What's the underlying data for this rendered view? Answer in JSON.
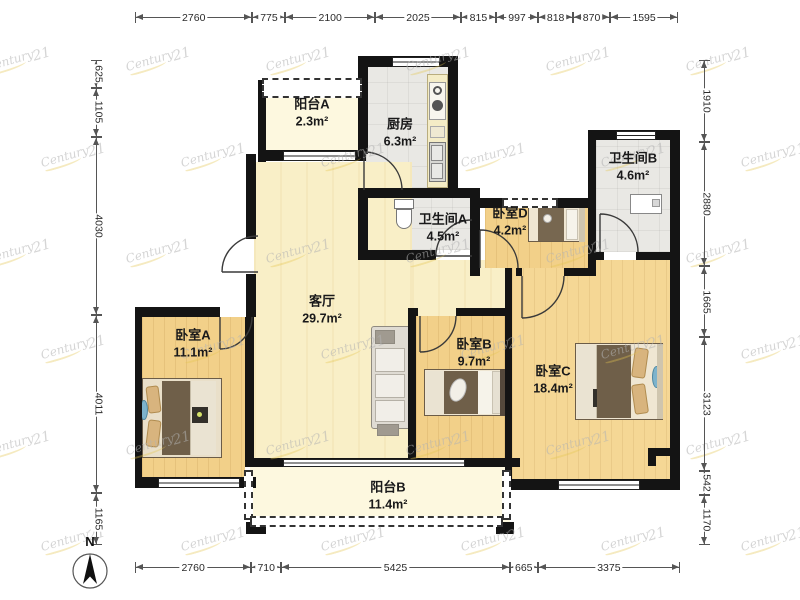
{
  "plan": {
    "compass_label": "N",
    "watermark": {
      "text": "Century",
      "suffix": "21"
    },
    "rooms": [
      {
        "id": "balcony_a",
        "name": "阳台A",
        "area": "2.3m²"
      },
      {
        "id": "kitchen",
        "name": "厨房",
        "area": "6.3m²"
      },
      {
        "id": "bath_b",
        "name": "卫生间B",
        "area": "4.6m²"
      },
      {
        "id": "bath_a",
        "name": "卫生间A",
        "area": "4.5m²"
      },
      {
        "id": "bed_d",
        "name": "卧室D",
        "area": "4.2m²"
      },
      {
        "id": "living",
        "name": "客厅",
        "area": "29.7m²"
      },
      {
        "id": "bed_a",
        "name": "卧室A",
        "area": "11.1m²"
      },
      {
        "id": "bed_b",
        "name": "卧室B",
        "area": "9.7m²"
      },
      {
        "id": "bed_c",
        "name": "卧室C",
        "area": "18.4m²"
      },
      {
        "id": "balcony_b",
        "name": "阳台B",
        "area": "11.4m²"
      }
    ]
  },
  "dimensions": {
    "top": [
      2760,
      775,
      2100,
      2025,
      815,
      997,
      818,
      870,
      1595
    ],
    "bottom": [
      2760,
      710,
      5425,
      665,
      3375
    ],
    "left": [
      625,
      1105,
      4030,
      4011,
      1165
    ],
    "right": [
      1910,
      2880,
      1665,
      3123,
      542,
      1170
    ]
  }
}
